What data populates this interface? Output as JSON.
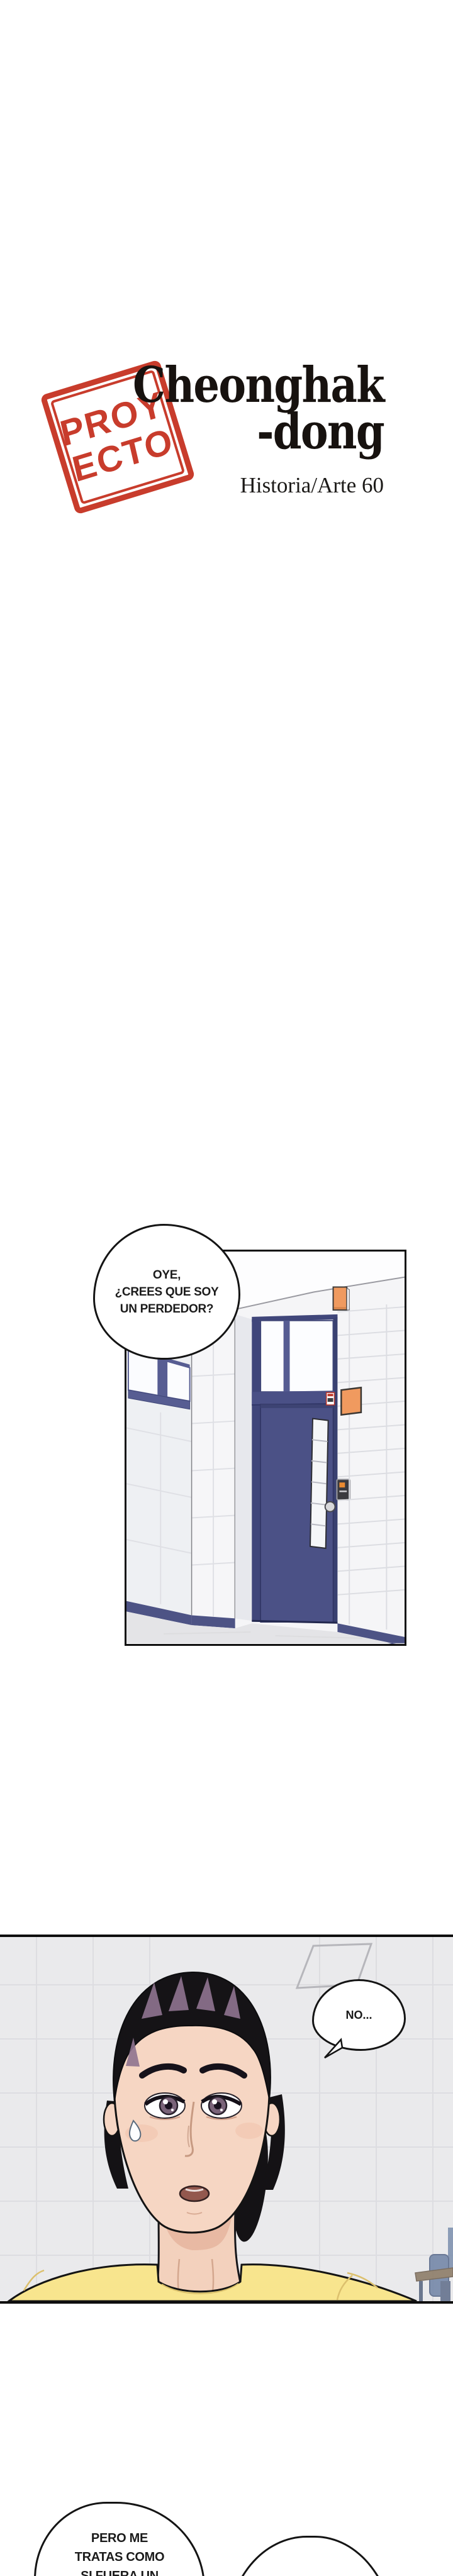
{
  "header": {
    "stamp": {
      "line1": "PROY",
      "line2": "ECTO"
    },
    "title": {
      "line1": "Cheonghak",
      "line2": "-dong"
    },
    "credit": "Historia/Arte 60"
  },
  "panel1": {
    "bubble": {
      "line1": "OYE,",
      "line2": "¿CREES QUE SOY",
      "line3": "UN PERDEDOR?"
    }
  },
  "panel2": {
    "bubble": {
      "text": "NO..."
    }
  },
  "footer": {
    "bubble_left": {
      "line1": "PERO ME",
      "line2": "TRATAS COMO",
      "line3": "SI FUERA UN"
    }
  },
  "colors": {
    "stamp_red": "#c5301f",
    "title_black": "#17120f",
    "door_blue": "#4b5186",
    "baseboard_blue": "#4d5385",
    "accent_orange": "#f09a5f",
    "shirt_yellow": "#f8e58e",
    "panel2_background": "#eaeaec",
    "skin": "#f6d6c3",
    "hair_black": "#151316",
    "hair_highlight": "#8f7490"
  }
}
